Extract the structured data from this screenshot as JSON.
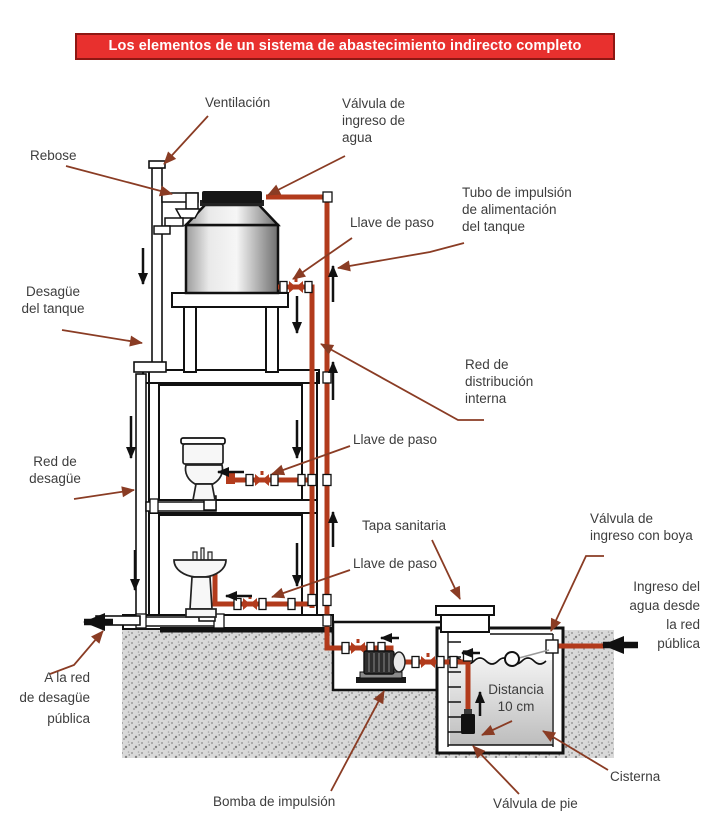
{
  "title": "Los elementos de un sistema de abastecimiento indirecto completo",
  "labels": {
    "ventilacion": "Ventilación",
    "valvula_ingreso_agua": "Válvula de\ningreso de\nagua",
    "rebose": "Rebose",
    "llave_de_paso_superior": "Llave de paso",
    "tubo_impulsion": "Tubo de impulsión\nde alimentación\ndel tanque",
    "desague_tanque": "Desagüe\ndel tanque",
    "red_distribucion": "Red de\ndistribución\ninterna",
    "llave_de_paso_medio": "Llave de paso",
    "red_desague": "Red de\ndesagüe",
    "tapa_sanitaria": "Tapa sanitaria",
    "valvula_ingreso_boya": "Válvula de\ningreso con boya",
    "llave_de_paso_inferior": "Llave de paso",
    "ingreso_agua_red_publica": "Ingreso del\nagua desde\nla red\npública",
    "a_red_desague_publica": "A la red\nde desagüe\npública",
    "distancia": "Distancia\n10 cm",
    "cisterna": "Cisterna",
    "bomba_impulsion": "Bomba de impulsión",
    "valvula_de_pie": "Válvula de pie"
  },
  "colors": {
    "title_background": "#e8302e",
    "title_border": "#8e1713",
    "pipe_water": "#b23b1c",
    "leader_arrow": "#8a3c24",
    "label_text": "#3d3d3d",
    "drain_outline": "#111111"
  }
}
